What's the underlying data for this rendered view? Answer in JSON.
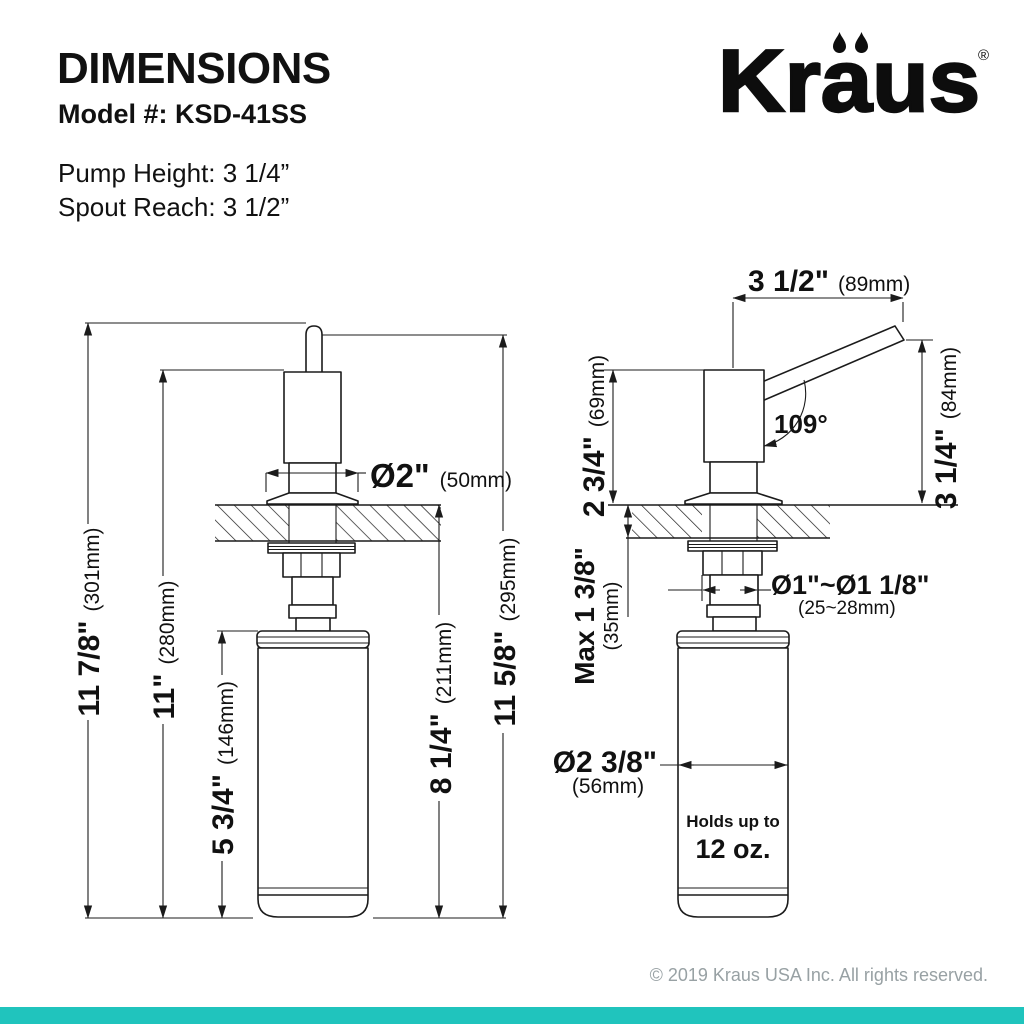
{
  "header": {
    "title": "DIMENSIONS",
    "model": "Model #: KSD-41SS",
    "pump_height": "Pump Height: 3 1/4”",
    "spout_reach": "Spout Reach: 3 1/2”"
  },
  "brand": {
    "name": "Kraus",
    "registered": "®"
  },
  "front_view": {
    "overall_height": {
      "inch": "11 7/8\"",
      "mm": "(301mm)"
    },
    "pump_top_height": {
      "inch": "11\"",
      "mm": "(280mm)"
    },
    "bottle_height": {
      "inch": "5 3/4\"",
      "mm": "(146mm)"
    },
    "below_counter": {
      "inch": "8 1/4\"",
      "mm": "(211mm)"
    },
    "spout_top_height": {
      "inch": "11 5/8\"",
      "mm": "(295mm)"
    },
    "flange_diameter": {
      "inch": "Ø2\"",
      "mm": "(50mm)"
    }
  },
  "side_view": {
    "spout_reach": {
      "inch": "3 1/2\"",
      "mm": "(89mm)"
    },
    "spout_angle": "109°",
    "above_counter": {
      "inch": "2 3/4\"",
      "mm": "(69mm)"
    },
    "spout_height": {
      "inch": "3 1/4\"",
      "mm": "(84mm)"
    },
    "counter_thickness": {
      "inch": "Max 1 3/8\"",
      "mm": "(35mm)"
    },
    "hole_diameter": {
      "inch": "Ø1\"~Ø1 1/8\"",
      "mm": "(25~28mm)"
    },
    "bottle_diameter": {
      "inch": "Ø2 3/8\"",
      "mm": "(56mm)"
    },
    "capacity_label": "Holds up to",
    "capacity_value": "12 oz."
  },
  "footer": {
    "copyright": "© 2019 Kraus USA Inc. All rights reserved."
  },
  "colors": {
    "accent": "#20c4bd",
    "ink": "#111111",
    "muted": "#98a1a4"
  }
}
